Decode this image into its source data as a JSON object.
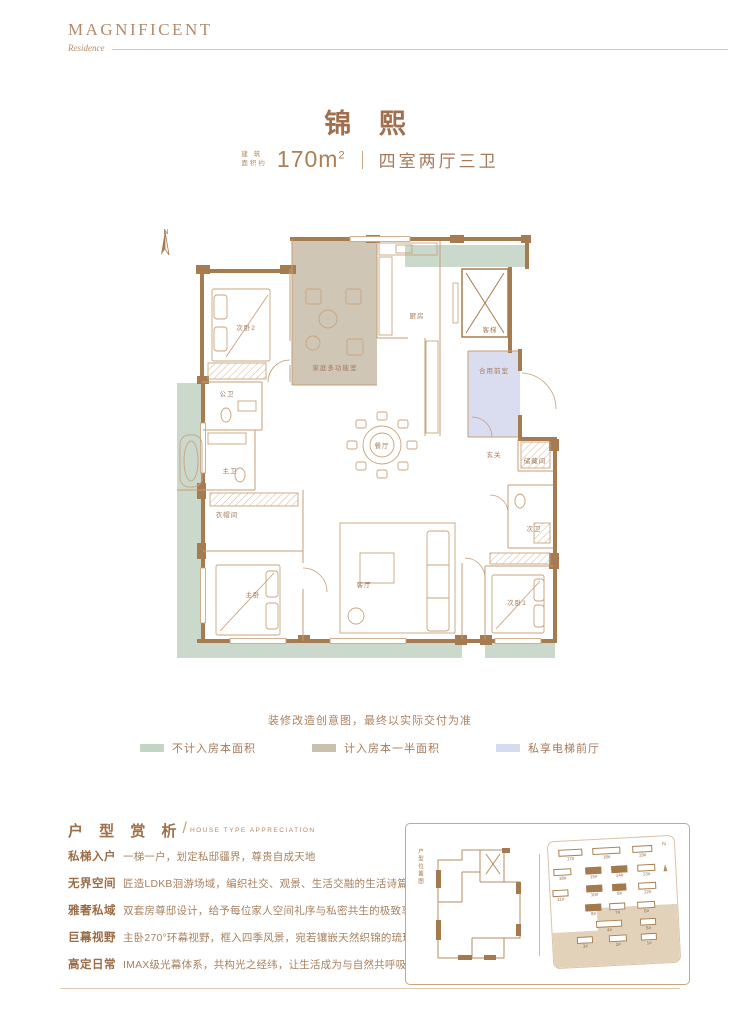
{
  "brand": {
    "name": "MAGNIFICENT",
    "subtitle": "Residence"
  },
  "title": "锦 熙",
  "spec": {
    "area_label_line1": "建 筑",
    "area_label_line2": "面积约",
    "area_value": "170m",
    "area_sup": "2",
    "layout": "四室两厅三卫"
  },
  "compass": {
    "label": "N"
  },
  "floorplan": {
    "rooms": [
      {
        "id": "bedroom-2",
        "label": "次卧2",
        "x": 96,
        "y": 104
      },
      {
        "id": "family-room",
        "label": "家庭多功能室",
        "x": 185,
        "y": 144
      },
      {
        "id": "kitchen",
        "label": "厨房",
        "x": 267,
        "y": 92
      },
      {
        "id": "passenger-elevator",
        "label": "客梯",
        "x": 340,
        "y": 106
      },
      {
        "id": "shared-lobby",
        "label": "合用前室",
        "x": 344,
        "y": 147
      },
      {
        "id": "guest-bath",
        "label": "公卫",
        "x": 77,
        "y": 170
      },
      {
        "id": "master-bath",
        "label": "主卫",
        "x": 80,
        "y": 247
      },
      {
        "id": "walk-in-closet",
        "label": "衣帽间",
        "x": 77,
        "y": 291
      },
      {
        "id": "master-bedroom",
        "label": "主卧",
        "x": 103,
        "y": 371
      },
      {
        "id": "dining-room",
        "label": "餐厅",
        "x": 232,
        "y": 222
      },
      {
        "id": "foyer",
        "label": "玄关",
        "x": 344,
        "y": 231
      },
      {
        "id": "storage-room",
        "label": "储藏间",
        "x": 385,
        "y": 237
      },
      {
        "id": "second-bath",
        "label": "次卫",
        "x": 384,
        "y": 305
      },
      {
        "id": "living-room",
        "label": "客厅",
        "x": 214,
        "y": 361
      },
      {
        "id": "bedroom-1",
        "label": "次卧1",
        "x": 367,
        "y": 379
      }
    ]
  },
  "note": "装修改造创意图，最终以实际交付为准",
  "legend": [
    {
      "label": "不计入房本面积",
      "color": "#C3D3C4"
    },
    {
      "label": "计入房本一半面积",
      "color": "#C9C0AF"
    },
    {
      "label": "私享电梯前厅",
      "color": "#D7DBF0"
    }
  ],
  "section": {
    "title": "户 型 赏 析",
    "subtitle": "HOUSE TYPE APPRECIATION"
  },
  "features": [
    {
      "term": "私梯入户",
      "desc": "一梯一户，划定私邸疆界，尊贵自成天地"
    },
    {
      "term": "无界空间",
      "desc": "匠造LDKB洄游场域，编织社交、观景、生活交融的生活诗篇"
    },
    {
      "term": "雅奢私域",
      "desc": "双套房尊邸设计，给予每位家人空间礼序与私密共生的极致享受"
    },
    {
      "term": "巨幕视野",
      "desc": "主卧270°环幕视野，框入四季风景，宛若镶嵌天然织锦的琉璃屏风"
    },
    {
      "term": "高定日常",
      "desc": "IMAX级光幕体系，共构光之经纬，让生活成为与自然共呼吸的艺术"
    }
  ],
  "keyplan": {
    "vertical_label": "户型位置图",
    "compass_label": "N",
    "buildings": [
      {
        "label": "17#",
        "x": 10,
        "y": 8,
        "w": 24,
        "dark": false
      },
      {
        "label": "18#",
        "x": 44,
        "y": 8,
        "w": 28,
        "dark": false
      },
      {
        "label": "19#",
        "x": 84,
        "y": 8,
        "w": 20,
        "dark": false
      },
      {
        "label": "16#",
        "x": 4,
        "y": 27,
        "w": 18,
        "dark": false
      },
      {
        "label": "15#",
        "x": 36,
        "y": 27,
        "w": 16,
        "dark": true
      },
      {
        "label": "14#",
        "x": 62,
        "y": 27,
        "w": 16,
        "dark": true
      },
      {
        "label": "13#",
        "x": 88,
        "y": 27,
        "w": 18,
        "dark": false
      },
      {
        "label": "11#",
        "x": 2,
        "y": 48,
        "w": 16,
        "dark": false
      },
      {
        "label": "10#",
        "x": 36,
        "y": 45,
        "w": 16,
        "dark": true
      },
      {
        "label": "9#",
        "x": 62,
        "y": 45,
        "w": 14,
        "dark": true
      },
      {
        "label": "12#",
        "x": 88,
        "y": 45,
        "w": 18,
        "dark": false
      },
      {
        "label": "8#",
        "x": 34,
        "y": 64,
        "w": 16,
        "dark": true
      },
      {
        "label": "7#",
        "x": 58,
        "y": 64,
        "w": 16,
        "dark": false
      },
      {
        "label": "6#",
        "x": 86,
        "y": 64,
        "w": 18,
        "dark": false
      },
      {
        "label": "4#",
        "x": 44,
        "y": 81,
        "w": 26,
        "dark": false
      },
      {
        "label": "5#",
        "x": 88,
        "y": 81,
        "w": 16,
        "dark": false
      },
      {
        "label": "3#",
        "x": 24,
        "y": 96,
        "w": 16,
        "dark": false
      },
      {
        "label": "2#",
        "x": 56,
        "y": 96,
        "w": 18,
        "dark": false
      },
      {
        "label": "1#",
        "x": 88,
        "y": 96,
        "w": 16,
        "dark": false
      }
    ]
  }
}
